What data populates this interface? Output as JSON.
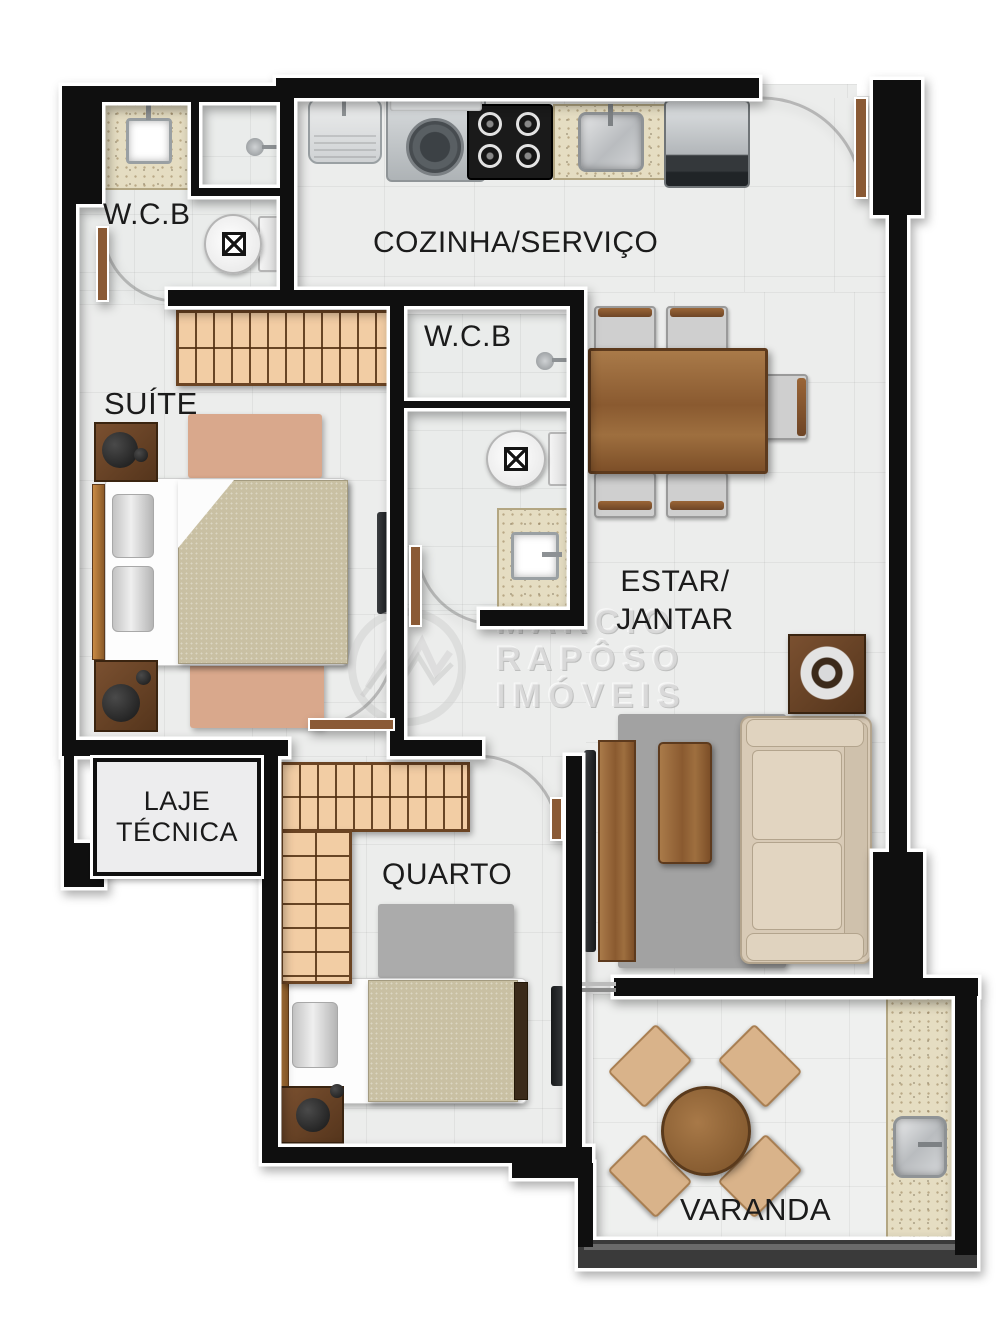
{
  "rooms": {
    "bathroom_top": {
      "label": "W.C.B"
    },
    "kitchen_service": {
      "label": "COZINHA/SERVIÇO"
    },
    "bathroom_middle": {
      "label": "W.C.B"
    },
    "suite": {
      "label": "SUÍTE"
    },
    "living_dining": {
      "line1": "ESTAR/",
      "line2": "JANTAR"
    },
    "technical_slab": {
      "line1": "LAJE",
      "line2": "TÉCNICA"
    },
    "bedroom": {
      "label": "QUARTO"
    },
    "balcony": {
      "label": "VARANDA"
    }
  },
  "watermark": {
    "line1": "MARCIO",
    "line2": "RAPÔSO",
    "line3": "IMÓVEIS"
  },
  "colors": {
    "wall": "#0f0f0f",
    "wall_outline": "#ffffff",
    "floor_tile": "#ecedec",
    "wood_medium": "#9a6a3e",
    "wood_dark": "#6e4526",
    "wardrobe_fill": "#f2cda4",
    "granite": "#e5ddc2",
    "bed_blanket": "#c9c0a3",
    "rug_pink": "#d9a88c",
    "rug_gray": "#ababab",
    "sofa": "#d8cab6",
    "railing": "#3a3a3a",
    "label_text": "#1b1b1b"
  }
}
